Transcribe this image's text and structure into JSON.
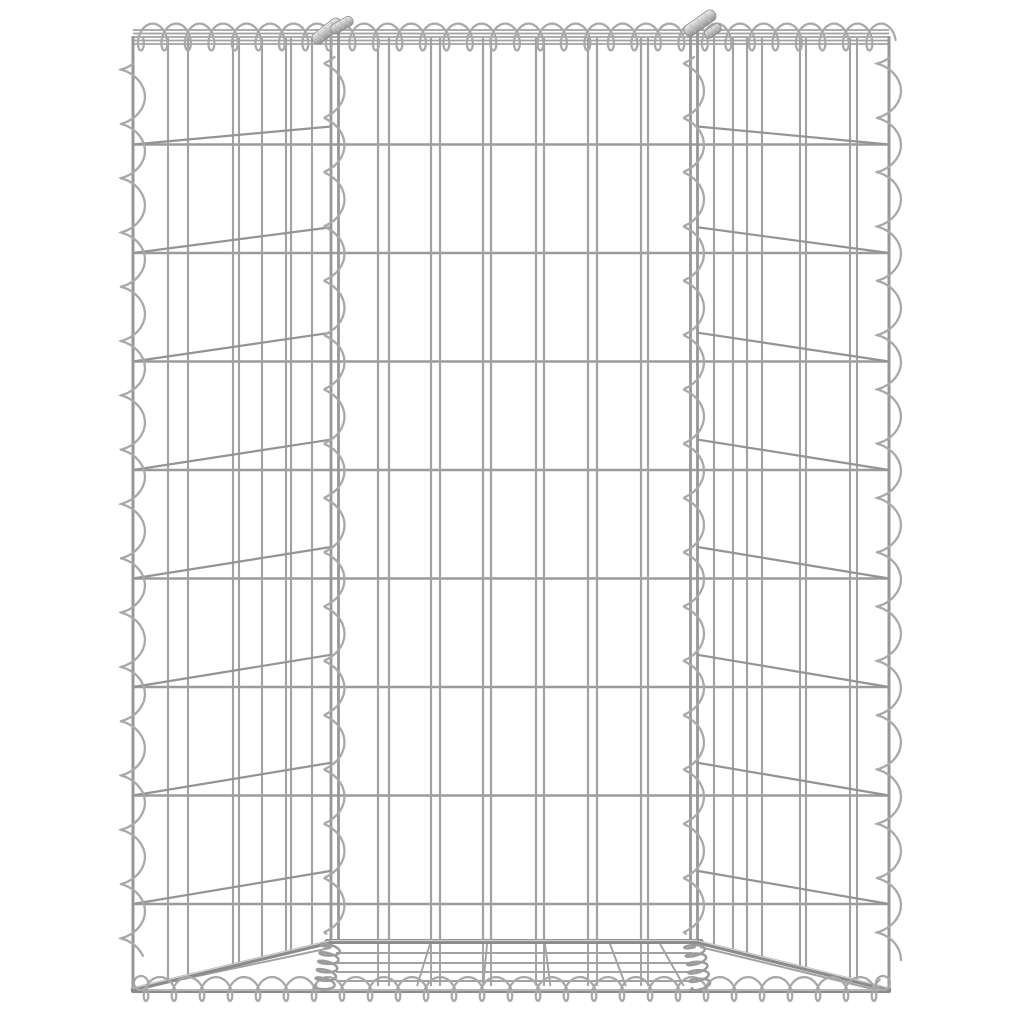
{
  "image": {
    "subject": "gabion-wire-basket-product-photo",
    "background_color": "#ffffff",
    "colors": {
      "wire": "#a2a2a2",
      "wire_dark": "#949494",
      "row": "#9b9b9b",
      "post": "#979797",
      "thick": "#8b8b8b",
      "thick_highlight": "#d2d2d2",
      "spiral": "#a9a9a9",
      "coil_dense": "#9c9c9c",
      "ferrule_light": "#e8e8e8",
      "ferrule_mid": "#bdbdbd",
      "ferrule_dark": "#8f8f8f"
    },
    "geometry": {
      "canvas": {
        "w": 1024,
        "h": 1024
      },
      "posts": {
        "outer_left_x": 133,
        "outer_right_x": 889,
        "inner_left": [
          331,
          338.5
        ],
        "inner_right": [
          690.5,
          697.5
        ],
        "top_y": 36,
        "outer_bottom_y": 990,
        "inner_bottom_y": 943
      },
      "top_rails_y": [
        30,
        33.5,
        37,
        40.5,
        44
      ],
      "rows_y": [
        144.5,
        253,
        361.5,
        470,
        578.5,
        687,
        795.5,
        904
      ],
      "row_span": [
        133,
        889
      ],
      "front_vertical_pairs": [
        [
          378,
          389
        ],
        [
          431,
          440
        ],
        [
          483,
          491
        ],
        [
          536,
          544
        ],
        [
          588,
          597
        ],
        [
          641,
          648
        ]
      ],
      "vertical_top_y": 38,
      "left_panel_verticals": [
        168,
        188,
        233,
        239,
        262,
        286,
        291,
        312
      ],
      "right_panel_verticals": [
        714,
        733,
        747,
        762,
        800,
        806,
        850,
        857
      ],
      "diag_offset": {
        "a": 36,
        "b": 2600,
        "min": 14
      },
      "front_bottom_rail": {
        "y": 941.5,
        "x1": 327,
        "x2": 701,
        "w": 5
      },
      "bottom_edge": {
        "y": 991,
        "x1": 133,
        "x2": 889,
        "w": 4
      },
      "corner_diagonals": [
        [
          133,
          989.5,
          329,
          942.5
        ],
        [
          889,
          989.5,
          699,
          942.5
        ]
      ],
      "thin_diagonals": [
        [
          141,
          988,
          330,
          948
        ],
        [
          700,
          947,
          881,
          991
        ]
      ],
      "corner_end_loops": [
        [
          141,
          983,
          7
        ],
        [
          883,
          983,
          7
        ]
      ],
      "base_rows": {
        "ys": [
          953,
          963,
          972,
          981
        ],
        "x1": 336,
        "x2": 692
      },
      "base_fan_top_xs": [
        430,
        487,
        545,
        610,
        660
      ],
      "base_fan_center": 511,
      "base_fan_factor": 0.16,
      "base_stub_y1": 944,
      "base_stub_y2": 986,
      "spirals": {
        "top": {
          "type": "h",
          "x": 135,
          "y": 37,
          "len": 753,
          "period": 23.5,
          "A": 13.5,
          "B": 8
        },
        "bottom": {
          "type": "h",
          "x": 139,
          "y": 989,
          "len": 747,
          "period": 28,
          "A": 12,
          "B": 8
        },
        "outer_left": {
          "type": "v",
          "x": 133,
          "y": 56,
          "len": 905,
          "period": 54.3,
          "A": 12,
          "B": 8
        },
        "outer_right": {
          "type": "v",
          "x": 889,
          "y": 50,
          "len": 910,
          "period": 54.3,
          "A": 12,
          "B": 8
        },
        "inner_left": {
          "type": "v",
          "x": 334.5,
          "y": 50,
          "len": 888,
          "period": 54.3,
          "A": 10,
          "B": 7
        },
        "inner_right": {
          "type": "v",
          "x": 694,
          "y": 50,
          "len": 888,
          "period": 54.3,
          "A": 10,
          "B": 7
        },
        "base_coil_left": {
          "type": "d",
          "x1": 331,
          "y1": 944,
          "x2": 324,
          "y2": 989,
          "period": 8.5,
          "A": 10,
          "B": 3.2
        },
        "base_coil_right": {
          "type": "d",
          "x1": 694,
          "y1": 944,
          "x2": 701,
          "y2": 989,
          "period": 8.5,
          "A": 10,
          "B": 3.2
        }
      },
      "ferrules": [
        {
          "cx": 327,
          "cy": 31,
          "w": 34,
          "h": 12,
          "angle": -38
        },
        {
          "cx": 342,
          "cy": 25,
          "w": 24,
          "h": 10,
          "angle": -30
        },
        {
          "cx": 700,
          "cy": 23,
          "w": 36,
          "h": 12,
          "angle": -35
        },
        {
          "cx": 713,
          "cy": 31,
          "w": 18,
          "h": 9,
          "angle": -35
        }
      ]
    }
  }
}
